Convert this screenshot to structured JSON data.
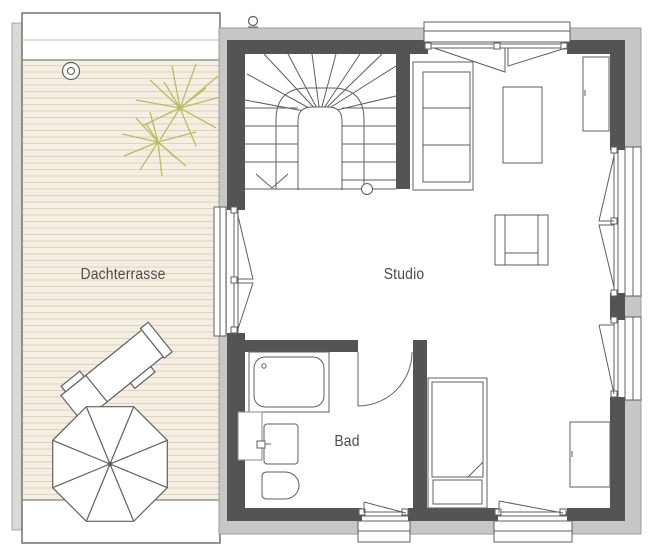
{
  "plan": {
    "type": "floor-plan",
    "rooms": {
      "terrace": {
        "label": "Dachterrasse"
      },
      "studio": {
        "label": "Studio"
      },
      "bath": {
        "label": "Bad"
      }
    },
    "elements": [
      "staircase-icon",
      "stair-down-arrow-icon",
      "plant-icon",
      "parasol-icon",
      "sun-lounger-icon",
      "sofa-shelf-icon",
      "coffee-table-icon",
      "wardrobe-icon",
      "armchair-icon",
      "sideboard-icon",
      "bed-icon",
      "bathtub-icon",
      "sink-icon",
      "toilet-icon",
      "door-swing-icon",
      "window-icon"
    ],
    "colors": {
      "wall_dark": "#545454",
      "facade_gray": "#c7c7c5",
      "deck_fill": "#f4efe2",
      "deck_line": "#dad3be",
      "plant_olive": "#b9bd62",
      "drawing_line": "#5f5f5f",
      "text": "#4c4c4c",
      "background": "#ffffff"
    }
  }
}
